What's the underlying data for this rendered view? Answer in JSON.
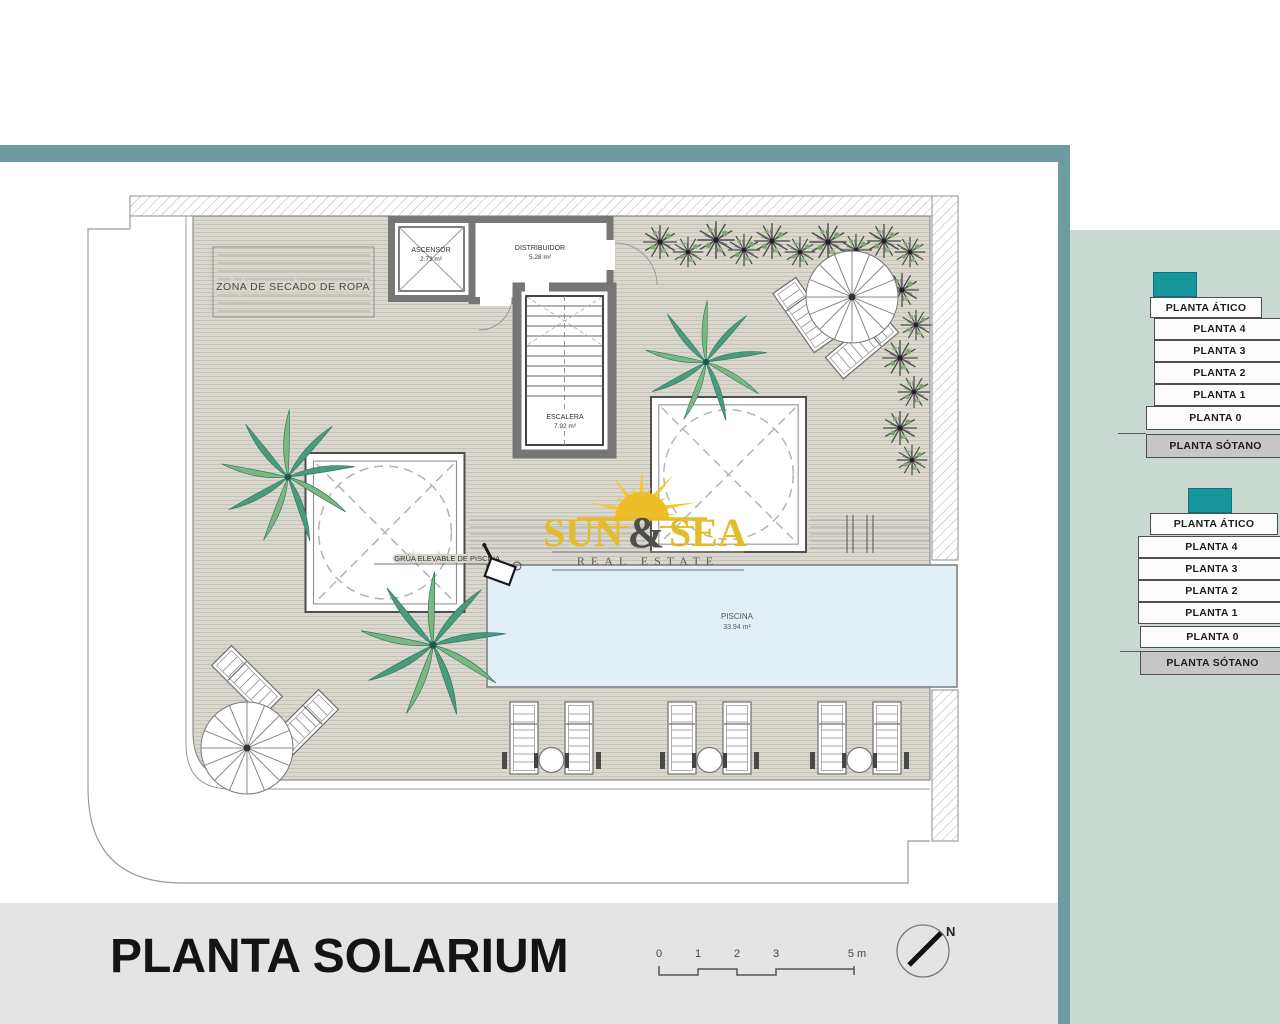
{
  "plan": {
    "title": "PLANTA SOLARIUM",
    "zona_secado_label": "ZONA DE SECADO DE ROPA",
    "rooms": {
      "ascensor": {
        "name": "ASCENSOR",
        "area": "2.73 m²"
      },
      "distribuidor": {
        "name": "DISTRIBUIDOR",
        "area": "5.28 m²"
      },
      "escalera": {
        "name": "ESCALERA",
        "area": "7.92 m²"
      },
      "piscina": {
        "name": "PISCINA",
        "area": "33.94 m²"
      }
    },
    "grua_label": "GRÚA ELEVABLE DE PISCINA",
    "scale_ticks": [
      "0",
      "1",
      "2",
      "3",
      "5 m"
    ],
    "north_label": "N"
  },
  "logo": {
    "word1": "SUN",
    "ampersand": "&",
    "word2": "SEA",
    "tagline": "REAL ESTATE"
  },
  "floor_nav": {
    "stacks": [
      {
        "floors": [
          "PLANTA ÁTICO",
          "PLANTA 4",
          "PLANTA 3",
          "PLANTA 2",
          "PLANTA 1",
          "PLANTA 0",
          "PLANTA SÓTANO"
        ]
      },
      {
        "floors": [
          "PLANTA ÁTICO",
          "PLANTA 4",
          "PLANTA 3",
          "PLANTA 2",
          "PLANTA 1",
          "PLANTA 0",
          "PLANTA SÓTANO"
        ]
      }
    ]
  },
  "colors": {
    "teal_frame": "#6e9aa2",
    "teal_block": "#17969e",
    "sage_panel": "#c9d9d2",
    "deck": "#d8d5cc",
    "pool": "#e2eff6",
    "bottom_bar": "#e4e4e4",
    "sotano_gray": "#c7c7c7",
    "logo_yellow": "#e5bd2a"
  }
}
